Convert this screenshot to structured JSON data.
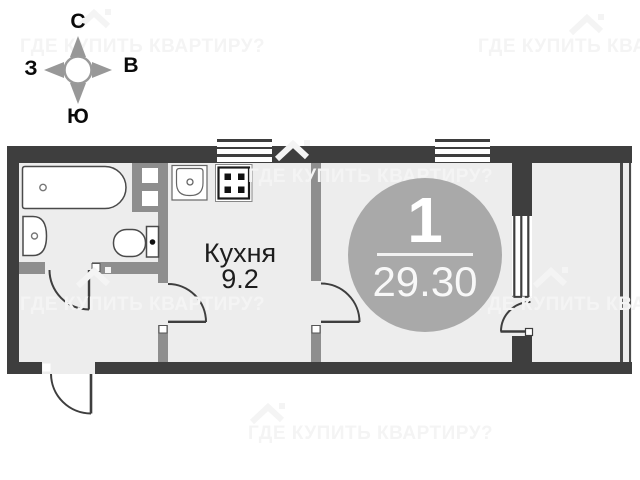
{
  "watermark": {
    "text": "ГДЕ КУПИТЬ КВАРТИРУ?"
  },
  "compass": {
    "north": "С",
    "east": "В",
    "south": "Ю",
    "west": "З"
  },
  "labels": {
    "kitchen_name": "Кухня",
    "kitchen_area": "9.2"
  },
  "badge": {
    "room_count": "1",
    "total_area": "29.30"
  },
  "colors": {
    "outer_wall": "#3e3e3e",
    "inner_wall": "#8e8e8e",
    "floor_fill": "#ededed",
    "fixture_outline": "#4a4a4a",
    "badge_circle": "#a9a9a9",
    "label_text": "#1d1d1d",
    "watermark": "#f4f4f4",
    "compass_gray": "#989898"
  }
}
